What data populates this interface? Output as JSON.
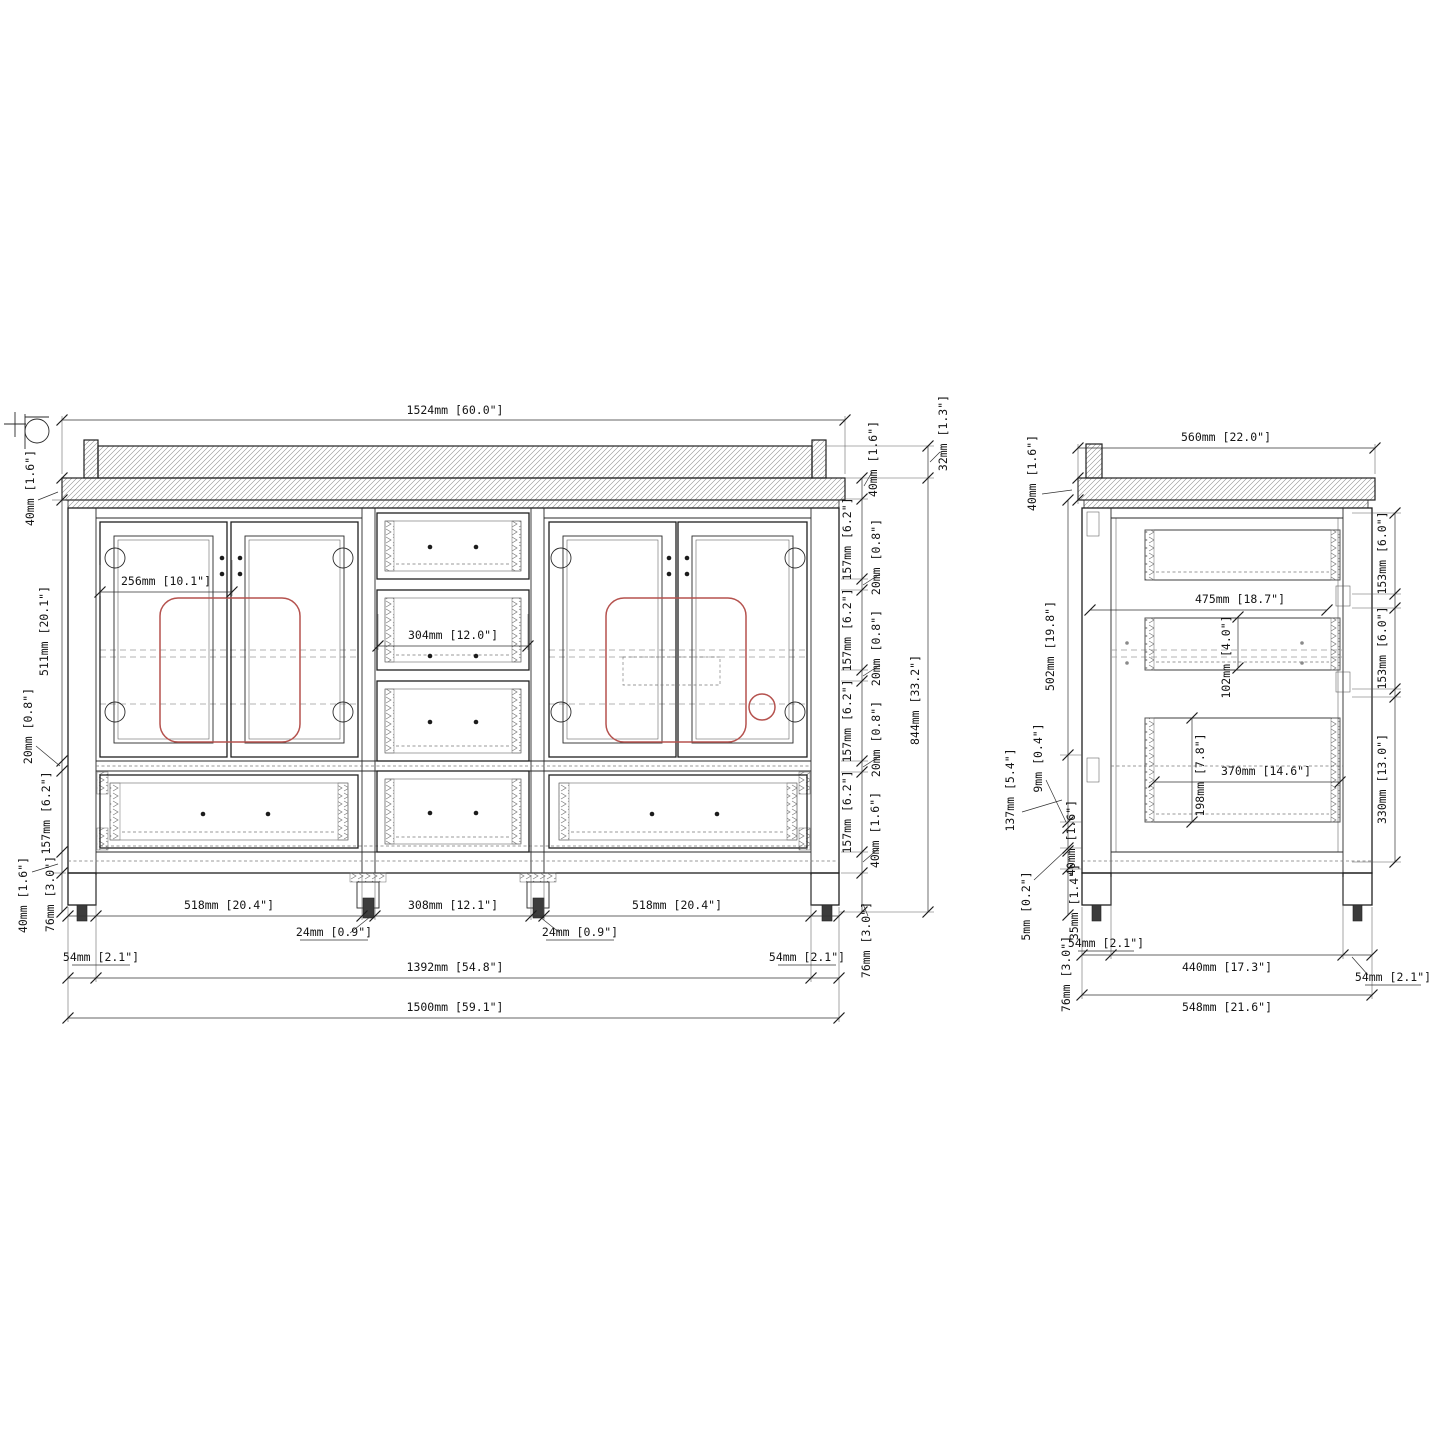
{
  "drawing": {
    "type": "cabinet-technical-drawing",
    "units": "mm [inches]",
    "colors": {
      "line": "#1f1f1f",
      "dashed": "#9b9b9b",
      "sink_outline": "#b5524e"
    }
  },
  "front_view": {
    "name": "front-elevation",
    "dims": {
      "top_width": "1524mm [60.0\"]",
      "counter_left_40": "40mm [1.6\"]",
      "door_height_511": "511mm [20.1\"]",
      "gap_left_20": "20mm [0.8\"]",
      "drawer_left_157": "157mm [6.2\"]",
      "rail_left_40": "40mm [1.6\"]",
      "leg_left_76": "76mm [3.0\"]",
      "hinge_256": "256mm [10.1\"]",
      "drawer_mid_304": "304mm [12.0\"]",
      "right_40_top": "40mm [1.6\"]",
      "right_32": "32mm [1.3\"]",
      "r157_1": "157mm [6.2\"]",
      "r20_1": "20mm [0.8\"]",
      "r157_2": "157mm [6.2\"]",
      "r20_2": "20mm [0.8\"]",
      "r157_3": "157mm [6.2\"]",
      "r20_3": "20mm [0.8\"]",
      "r157_4": "157mm [6.2\"]",
      "r40_bottom": "40mm [1.6\"]",
      "r76_bottom": "76mm [3.0\"]",
      "total_844": "844mm [33.2\"]",
      "b518_left": "518mm [20.4\"]",
      "b24_left": "24mm [0.9\"]",
      "b308": "308mm [12.1\"]",
      "b24_right": "24mm [0.9\"]",
      "b518_right": "518mm [20.4\"]",
      "b54_left": "54mm [2.1\"]",
      "b1392": "1392mm [54.8\"]",
      "b54_right": "54mm [2.1\"]",
      "b1500": "1500mm [59.1\"]"
    }
  },
  "side_view": {
    "name": "side-section",
    "dims": {
      "top_560": "560mm [22.0\"]",
      "c40_top": "40mm [1.6\"]",
      "h502": "502mm [19.8\"]",
      "h137": "137mm [5.4\"]",
      "h9": "9mm [0.4\"]",
      "h40": "40mm [1.6\"]",
      "h5": "5mm [0.2\"]",
      "h35": "35mm [1.4\"]",
      "h76": "76mm [3.0\"]",
      "d475": "475mm [18.7\"]",
      "d102": "102mm [4.0\"]",
      "d198": "198mm [7.8\"]",
      "d370": "370mm [14.6\"]",
      "dr153_1": "153mm [6.0\"]",
      "dr153_2": "153mm [6.0\"]",
      "dr330": "330mm [13.0\"]",
      "b54_left": "54mm [2.1\"]",
      "b440": "440mm [17.3\"]",
      "b54_right": "54mm [2.1\"]",
      "b548": "548mm [21.6\"]"
    }
  }
}
